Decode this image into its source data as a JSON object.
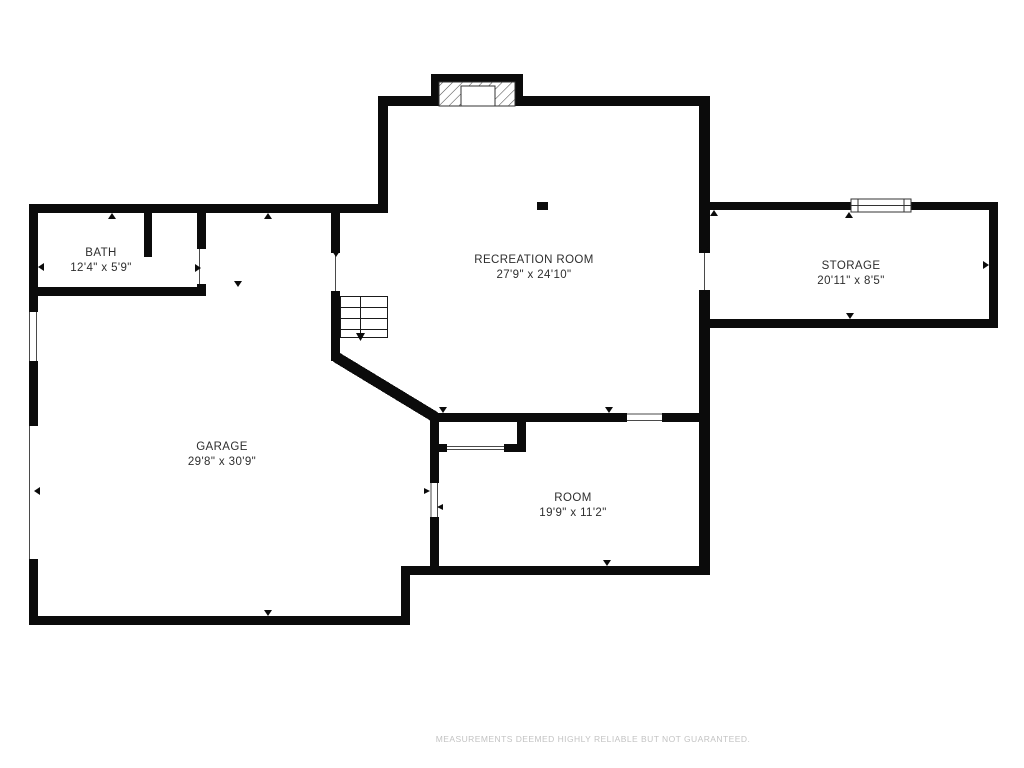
{
  "floor_plan": {
    "rooms": [
      {
        "id": "bath",
        "name": "BATH",
        "dimensions": "12'4\" x 5'9\""
      },
      {
        "id": "recreation-room",
        "name": "RECREATION ROOM",
        "dimensions": "27'9\" x 24'10\""
      },
      {
        "id": "storage",
        "name": "STORAGE",
        "dimensions": "20'11\" x 8'5\""
      },
      {
        "id": "garage",
        "name": "GARAGE",
        "dimensions": "29'8\" x 30'9\""
      },
      {
        "id": "room",
        "name": "ROOM",
        "dimensions": "19'9\" x 11'2\""
      }
    ],
    "features": [
      "staircase-down",
      "fireplace",
      "window",
      "closet",
      "door-openings"
    ],
    "disclaimer": "MEASUREMENTS DEEMED HIGHLY RELIABLE BUT NOT GUARANTEED.",
    "colors": {
      "wall": "#0b0b0b",
      "background": "#ffffff",
      "label": "#2e2e2e",
      "disclaimer": "#c3c3c3"
    }
  }
}
